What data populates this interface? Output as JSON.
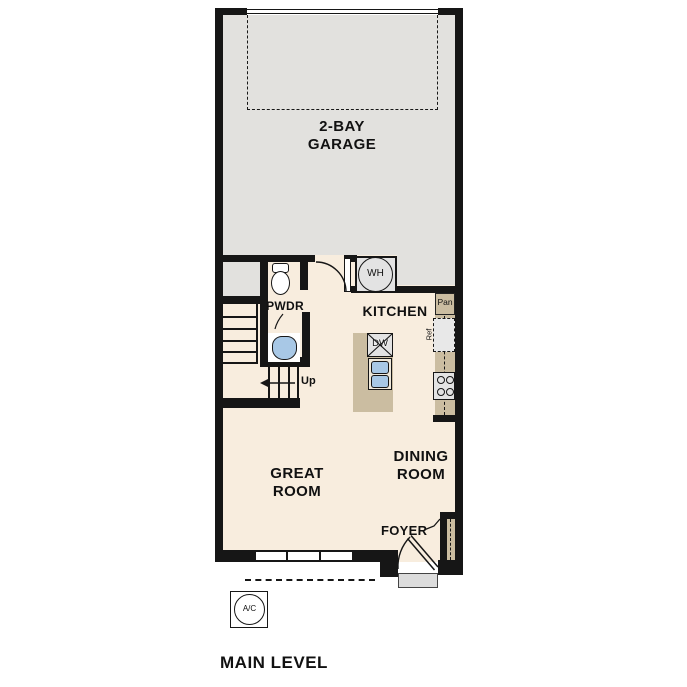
{
  "plan": {
    "title": "MAIN LEVEL"
  },
  "rooms": {
    "garage": {
      "line1": "2-BAY",
      "line2": "GARAGE"
    },
    "kitchen": {
      "label": "KITCHEN"
    },
    "powder": {
      "label": "PWDR"
    },
    "great": {
      "line1": "GREAT",
      "line2": "ROOM"
    },
    "dining": {
      "line1": "DINING",
      "line2": "ROOM"
    },
    "foyer": {
      "label": "FOYER"
    }
  },
  "fixtures": {
    "water_heater": "WH",
    "dishwasher": "DW",
    "pantry": "Pan",
    "refrigerator": "Ref",
    "ac": "A/C"
  },
  "stairs": {
    "up": "Up"
  },
  "colors": {
    "wall": "#161616",
    "garage_floor": "#e2e1de",
    "living_floor": "#f8edde",
    "cabinet_tan": "#cbbda1",
    "fixture_gray": "#e3e3e3",
    "sink_blue": "#a8c8e6",
    "porch_gray": "#dcdcdc"
  }
}
